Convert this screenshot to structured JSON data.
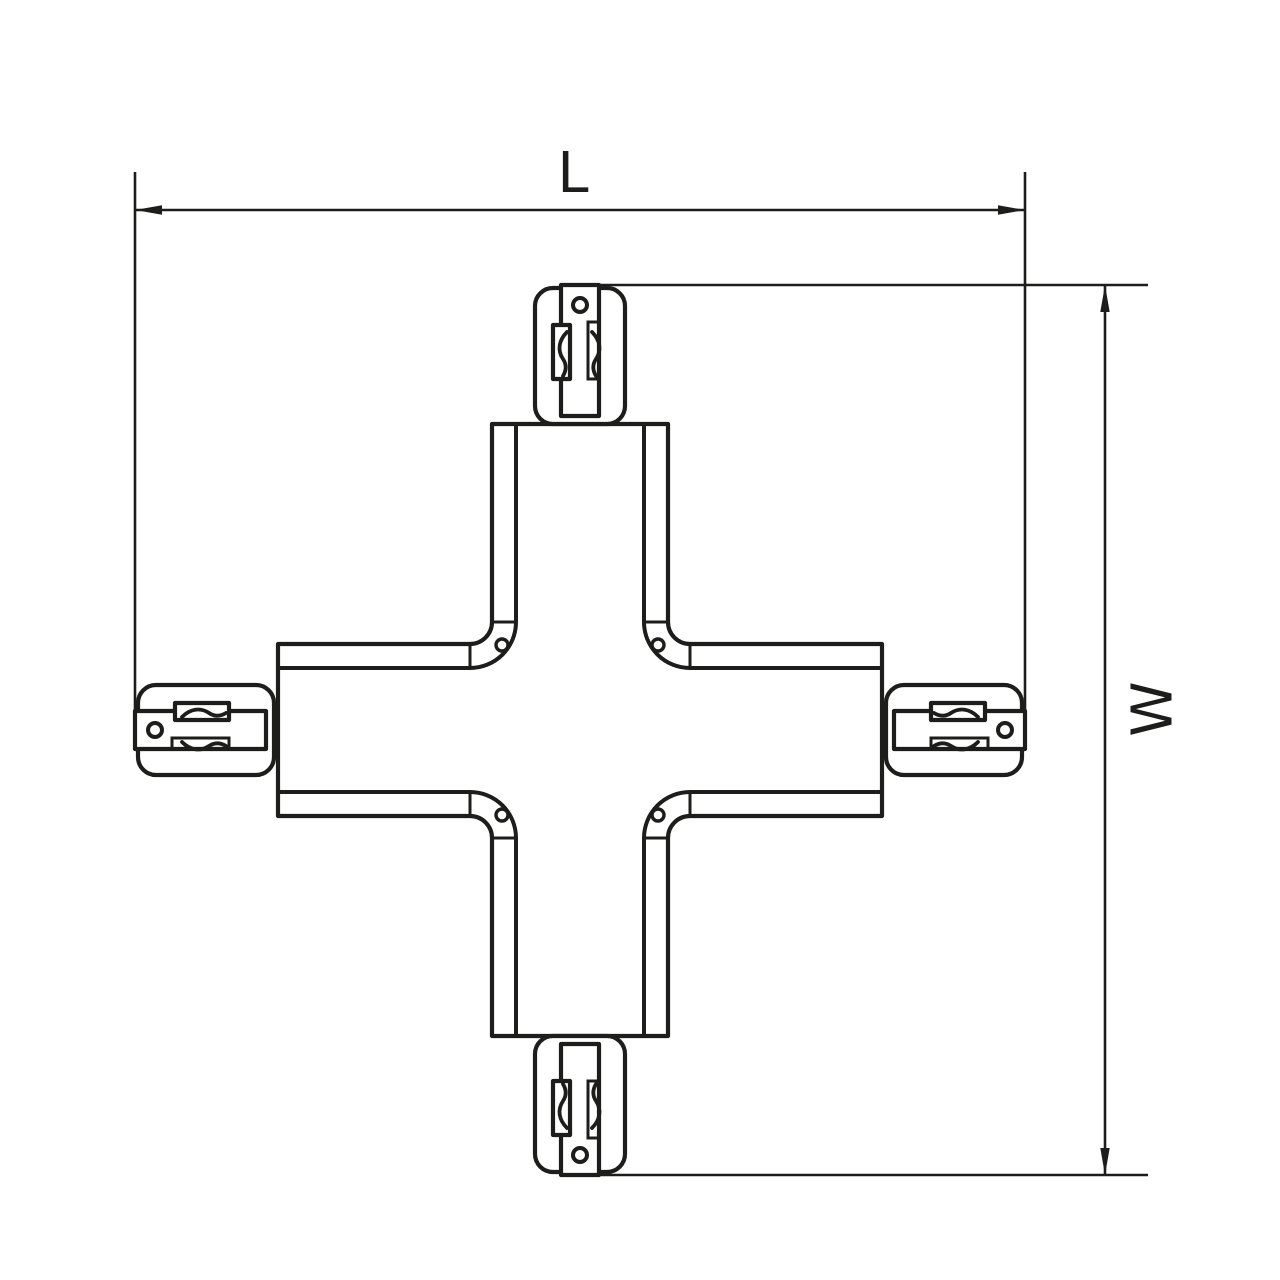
{
  "page": {
    "background_color": "#ffffff",
    "line_color": "#1d1d1b"
  },
  "drawing": {
    "type": "technical-line-drawing",
    "subject": "four-way X-shaped track connector, plan view",
    "dimensions": {
      "length_label": "L",
      "width_label": "W"
    }
  }
}
